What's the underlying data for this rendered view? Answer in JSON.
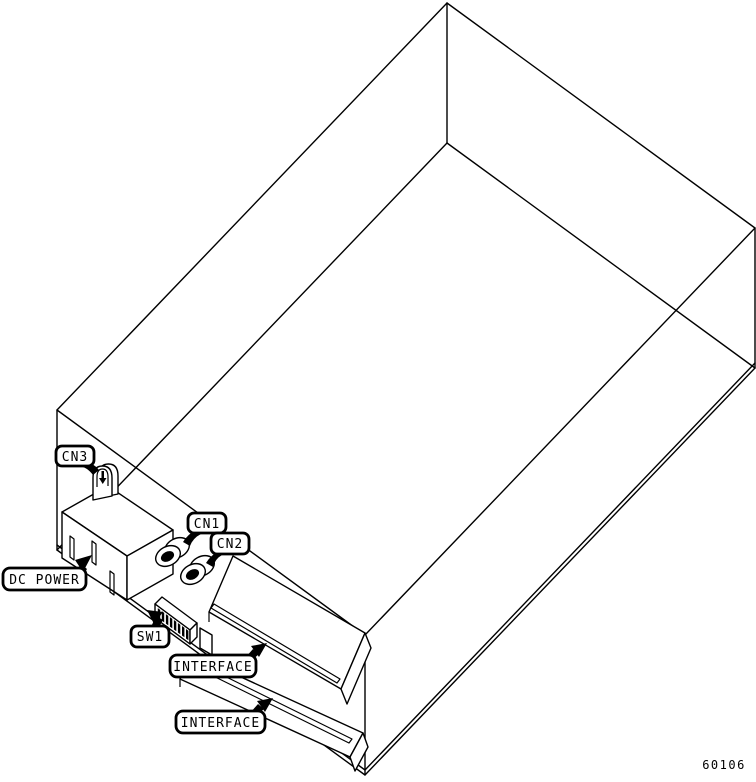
{
  "figure": {
    "number": "60106",
    "background": "#ffffff",
    "line_color": "#000000",
    "callouts": {
      "cn3": "CN3",
      "cn1": "CN1",
      "cn2": "CN2",
      "dc_power": "DC POWER",
      "sw1": "SW1",
      "interface_top": "INTERFACE",
      "interface_bottom": "INTERFACE"
    }
  }
}
